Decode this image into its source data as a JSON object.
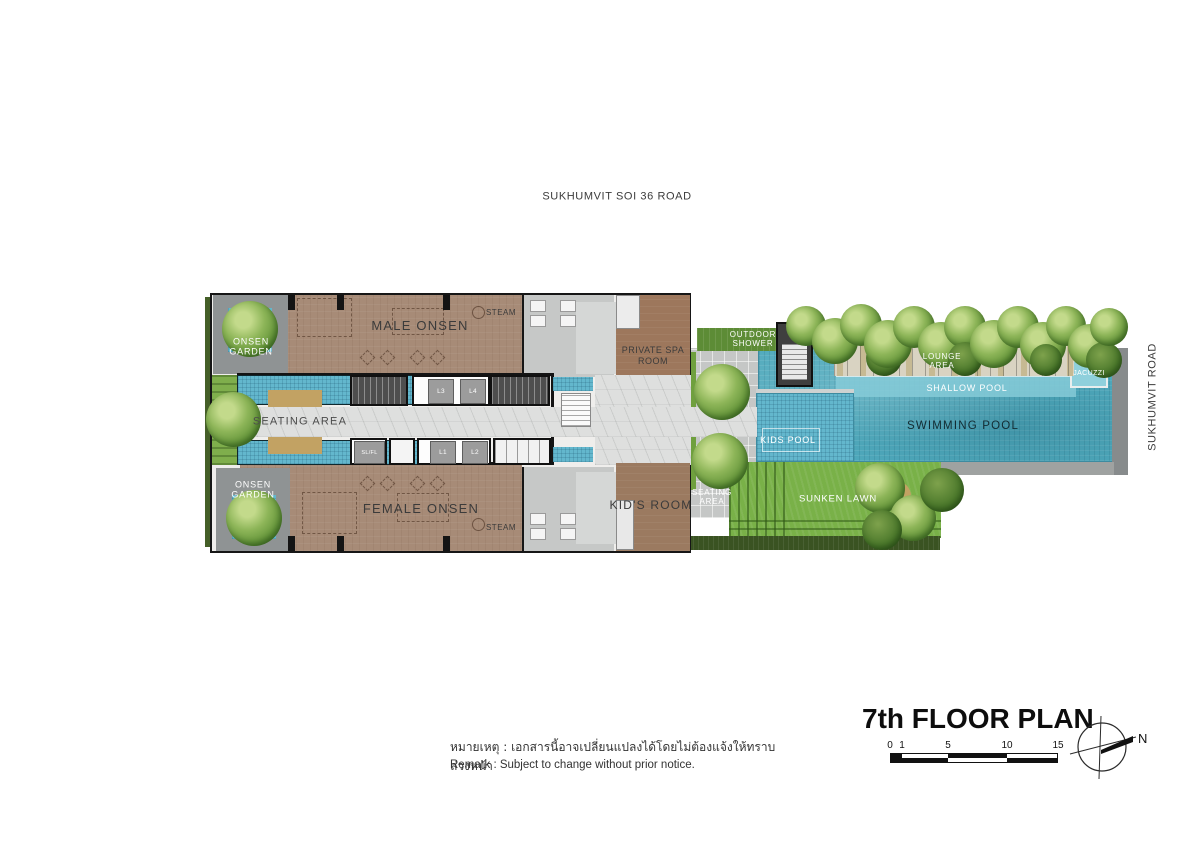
{
  "roads": {
    "top_label": "SUKHUMVIT SOI 36 ROAD",
    "right_label": "SUKHUMVIT ROAD"
  },
  "rooms": {
    "onsen_garden_top": "ONSEN GARDEN",
    "male_onsen": "MALE ONSEN",
    "steam_top": "STEAM",
    "private_spa_room": "PRIVATE SPA ROOM",
    "seating_area": "SEATING AREA",
    "onsen_garden_bottom": "ONSEN GARDEN",
    "female_onsen": "FEMALE ONSEN",
    "steam_bottom": "STEAM",
    "kids_room": "KID'S ROOM",
    "outdoor_shower": "OUTDOOR SHOWER",
    "lounge_area": "LOUNGE AREA",
    "jacuzzi": "JACUZZI",
    "shallow_pool": "SHALLOW POOL",
    "swimming_pool": "SWIMMING POOL",
    "kids_pool": "KIDS POOL",
    "seating_area_deck": "SEATING AREA",
    "sunken_lawn": "SUNKEN LAWN"
  },
  "lifts": {
    "l1": "L1",
    "l2": "L2",
    "l3": "L3",
    "l4": "L4",
    "service": "SL/FL"
  },
  "footer": {
    "title": "7th FLOOR PLAN",
    "remark_th": "หมายเหตุ : เอกสารนี้อาจเปลี่ยนแปลงได้โดยไม่ต้องแจ้งให้ทราบล่วงหน้า",
    "remark_en": "Remark  :  Subject to change without prior notice.",
    "scale_ticks": [
      "0",
      "1",
      "5",
      "10",
      "15"
    ],
    "compass_north": "N"
  },
  "colors": {
    "pool_water": "#4fa9bc",
    "onsen_floor": "#a78b77",
    "lawn_green": "#79b148",
    "deck_grey": "#c5c7c6",
    "platform_tan": "#c2a263"
  }
}
